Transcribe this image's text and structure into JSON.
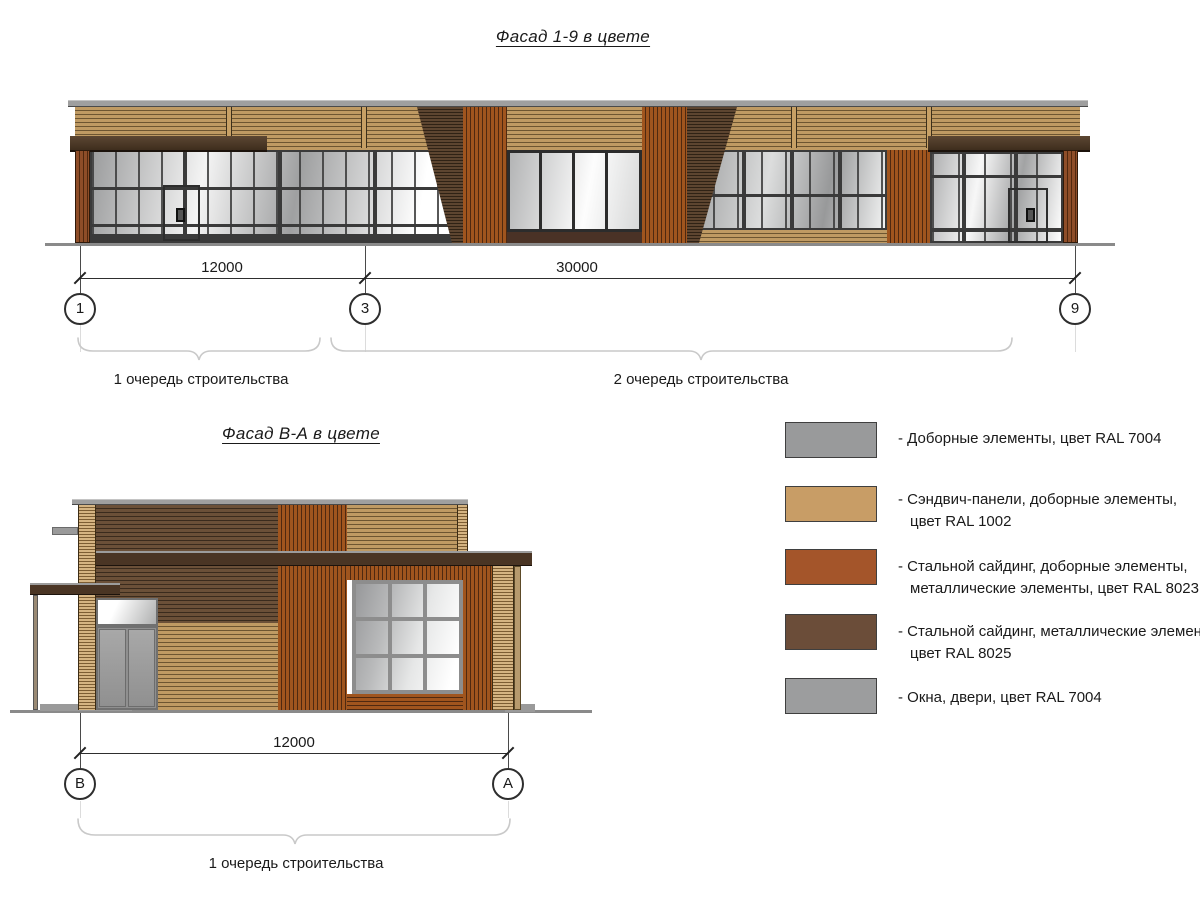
{
  "facades": {
    "main": {
      "title": "Фасад 1-9 в цвете",
      "axes": [
        "1",
        "3",
        "9"
      ],
      "dimensions": [
        "12000",
        "30000"
      ],
      "phases": [
        "1 очередь строительства",
        "2 очередь строительства"
      ]
    },
    "side": {
      "title": "Фасад В-А в цвете",
      "axes": [
        "В",
        "А"
      ],
      "dimensions": [
        "12000"
      ],
      "phases": [
        "1 очередь строительства"
      ]
    }
  },
  "legend": {
    "items": [
      {
        "ral": "RAL 7004",
        "color": "#999a9b",
        "lines": [
          "- Доборные элементы, цвет RAL 7004",
          ""
        ]
      },
      {
        "ral": "RAL 1002",
        "color": "#c89d66",
        "lines": [
          "- Сэндвич-панели, доборные элементы,",
          "цвет RAL 1002"
        ]
      },
      {
        "ral": "RAL 8023",
        "color": "#a4552a",
        "lines": [
          "- Стальной сайдинг, доборные элементы,",
          "металлические элементы, цвет RAL 8023"
        ]
      },
      {
        "ral": "RAL 8025",
        "color": "#6b4d39",
        "lines": [
          "- Стальной сайдинг, металлические элементы,",
          "цвет RAL 8025"
        ]
      },
      {
        "ral": "RAL 7004",
        "color": "#9c9d9e",
        "lines": [
          "- Окна, двери, цвет RAL 7004",
          ""
        ]
      }
    ]
  },
  "materials": {
    "wood_tan": "#bf9a63",
    "dark_beam_brown": "#4a3524",
    "orange_siding": "#a0551e",
    "dark_siding": "#5d4530",
    "glass_gray": "#9b9c9d",
    "coping_gray": "#9f9f9f"
  }
}
